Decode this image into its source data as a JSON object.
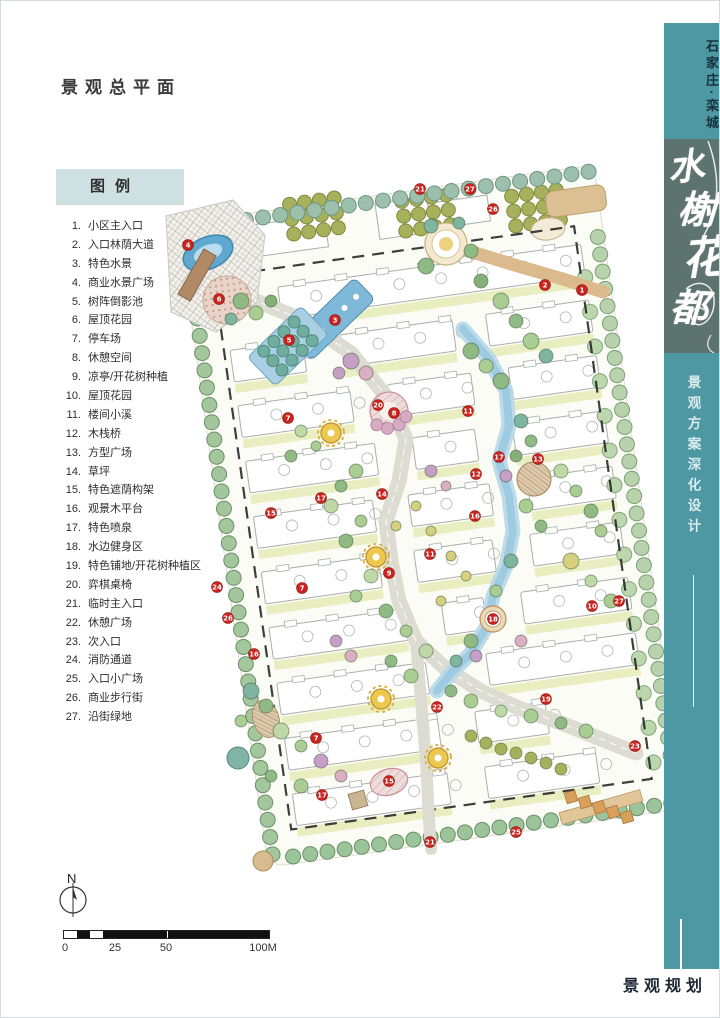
{
  "page": {
    "title": "景观总平面",
    "footer": "景观规划"
  },
  "legend": {
    "title": "图例",
    "items": [
      {
        "num": "1",
        "label": "小区主入口"
      },
      {
        "num": "2",
        "label": "入口林荫大道"
      },
      {
        "num": "3",
        "label": "特色水景"
      },
      {
        "num": "4",
        "label": "商业水景广场"
      },
      {
        "num": "5",
        "label": "树阵倒影池"
      },
      {
        "num": "6",
        "label": "屋顶花园"
      },
      {
        "num": "7",
        "label": "停车场"
      },
      {
        "num": "8",
        "label": "休憩空间"
      },
      {
        "num": "9",
        "label": "凉亭/开花树种植"
      },
      {
        "num": "10",
        "label": "屋顶花园"
      },
      {
        "num": "11",
        "label": "楼间小溪"
      },
      {
        "num": "12",
        "label": "木栈桥"
      },
      {
        "num": "13",
        "label": "方型广场"
      },
      {
        "num": "14",
        "label": "草坪"
      },
      {
        "num": "15",
        "label": "特色遮荫构架"
      },
      {
        "num": "16",
        "label": "观景木平台"
      },
      {
        "num": "17",
        "label": "特色喷泉"
      },
      {
        "num": "18",
        "label": "水边健身区"
      },
      {
        "num": "19",
        "label": "特色铺地/开花树种植区"
      },
      {
        "num": "20",
        "label": "弈棋桌椅"
      },
      {
        "num": "21",
        "label": "临时主入口"
      },
      {
        "num": "22",
        "label": "休憩广场"
      },
      {
        "num": "23",
        "label": "次入口"
      },
      {
        "num": "24",
        "label": "消防通道"
      },
      {
        "num": "25",
        "label": "入口小广场"
      },
      {
        "num": "26",
        "label": "商业步行街"
      },
      {
        "num": "27",
        "label": "沿街绿地"
      }
    ]
  },
  "compass": {
    "north_label": "N"
  },
  "scalebar": {
    "labels": [
      "0",
      "25",
      "50",
      "100M"
    ]
  },
  "sidebar": {
    "location": "石家庄·栾城",
    "project_name": "水榭花都",
    "subtitle": "景观方案深化设计"
  },
  "colors": {
    "sidebar_teal": "#4e98a3",
    "sidebar_panel": "#5d7370",
    "legend_box": "#cfe0e3",
    "marker_red": "#c9241f",
    "water_blue": "#9ecbe2",
    "road_grey": "#dcdcd2",
    "lawn_green": "#e8eec0",
    "tree_green": "#9cc39b"
  },
  "plan": {
    "marker_color": "#c9241f",
    "markers": [
      {
        "n": "1",
        "x": 581,
        "y": 289
      },
      {
        "n": "2",
        "x": 544,
        "y": 284
      },
      {
        "n": "3",
        "x": 334,
        "y": 319
      },
      {
        "n": "4",
        "x": 187,
        "y": 244
      },
      {
        "n": "5",
        "x": 288,
        "y": 339
      },
      {
        "n": "6",
        "x": 218,
        "y": 298
      },
      {
        "n": "7",
        "x": 287,
        "y": 417
      },
      {
        "n": "7",
        "x": 301,
        "y": 587
      },
      {
        "n": "7",
        "x": 315,
        "y": 737
      },
      {
        "n": "8",
        "x": 393,
        "y": 412
      },
      {
        "n": "9",
        "x": 388,
        "y": 572
      },
      {
        "n": "10",
        "x": 591,
        "y": 605
      },
      {
        "n": "11",
        "x": 467,
        "y": 410
      },
      {
        "n": "11",
        "x": 429,
        "y": 553
      },
      {
        "n": "12",
        "x": 475,
        "y": 473
      },
      {
        "n": "13",
        "x": 537,
        "y": 458
      },
      {
        "n": "14",
        "x": 381,
        "y": 493
      },
      {
        "n": "15",
        "x": 270,
        "y": 512
      },
      {
        "n": "15",
        "x": 388,
        "y": 780
      },
      {
        "n": "16",
        "x": 474,
        "y": 515
      },
      {
        "n": "16",
        "x": 253,
        "y": 653
      },
      {
        "n": "17",
        "x": 498,
        "y": 456
      },
      {
        "n": "17",
        "x": 320,
        "y": 497
      },
      {
        "n": "17",
        "x": 321,
        "y": 794
      },
      {
        "n": "18",
        "x": 492,
        "y": 618
      },
      {
        "n": "19",
        "x": 545,
        "y": 698
      },
      {
        "n": "20",
        "x": 377,
        "y": 404
      },
      {
        "n": "21",
        "x": 419,
        "y": 188
      },
      {
        "n": "21",
        "x": 429,
        "y": 841
      },
      {
        "n": "22",
        "x": 436,
        "y": 706
      },
      {
        "n": "23",
        "x": 634,
        "y": 745
      },
      {
        "n": "24",
        "x": 216,
        "y": 586
      },
      {
        "n": "25",
        "x": 515,
        "y": 831
      },
      {
        "n": "26",
        "x": 492,
        "y": 208
      },
      {
        "n": "26",
        "x": 227,
        "y": 617
      },
      {
        "n": "27",
        "x": 469,
        "y": 188
      },
      {
        "n": "27",
        "x": 618,
        "y": 600
      }
    ]
  }
}
